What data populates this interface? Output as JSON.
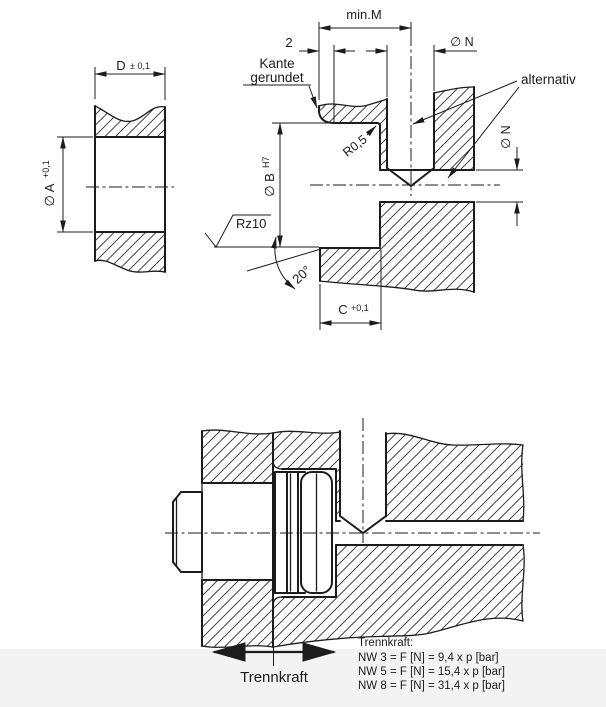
{
  "drawing": {
    "title": "coupling installation technical drawing",
    "background": "#ffffff",
    "line_color": "#1c1c1c",
    "footer_band_color": "#f3f3f3",
    "left_view": {
      "width_dim": {
        "label": "D",
        "tol": "± 0,1"
      },
      "bore_dim": {
        "label": "∅ A",
        "tol": "+0,1"
      }
    },
    "detail_view": {
      "min_depth_label": "min.M",
      "edge_width_label": "2",
      "feed_bore_top_label": "∅ N",
      "feed_bore_side_label": "∅ N",
      "bore_dim": {
        "label": "∅ B",
        "tol": "H7"
      },
      "depth_dim": {
        "label": "C",
        "tol": "+0,1"
      },
      "radius_label": "R0,5",
      "angle_label": "20°",
      "surface_label": "Rz10",
      "note_edge_line1": "Kante",
      "note_edge_line2": "gerundet",
      "note_alternative": "alternativ"
    },
    "assembly_view": {
      "force_label": "Trennkraft",
      "formula_title": "Trennkraft:",
      "formulas": [
        "NW 3 = F [N] = 9,4 x p [bar]",
        "NW 5 = F [N] = 15,4 x p [bar]",
        "NW 8 = F [N] = 31,4 x p [bar]"
      ]
    }
  }
}
